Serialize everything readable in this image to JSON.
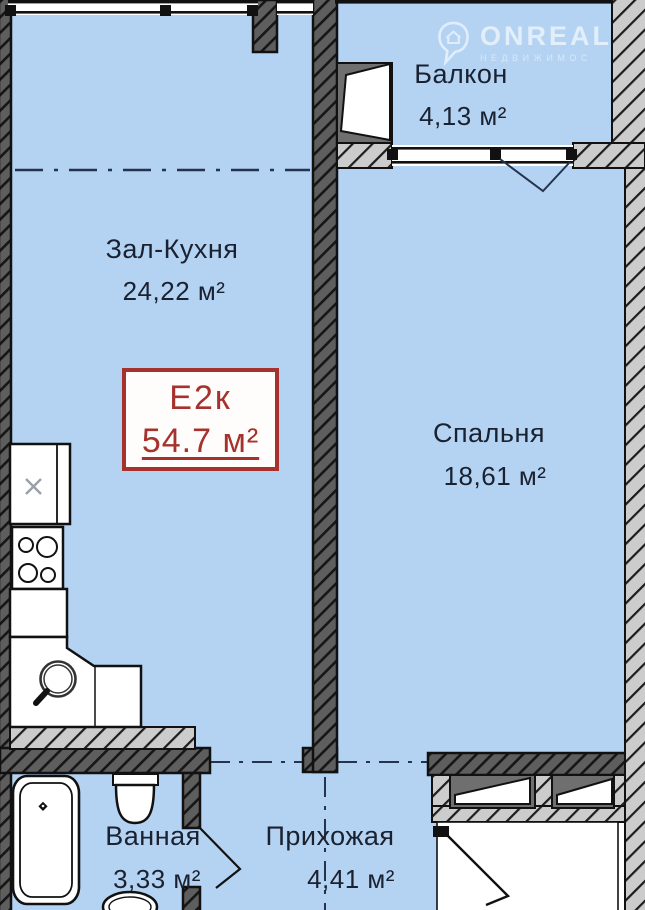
{
  "brand": {
    "name": "ONREAL",
    "subtitle": "НЕДВИЖИМОС"
  },
  "badge": {
    "type": "Е2к",
    "area": "54.7 м²"
  },
  "rooms": {
    "living_kitchen": {
      "name": "Зал-Кухня",
      "area": "24,22 м²"
    },
    "balcony": {
      "name": "Балкон",
      "area": "4,13 м²"
    },
    "bedroom": {
      "name": "Спальня",
      "area": "18,61 м²"
    },
    "bathroom": {
      "name": "Ванная",
      "area": "3,33 м²"
    },
    "hallway": {
      "name": "Прихожая",
      "area": "4,41 м²"
    }
  },
  "colors": {
    "room_fill": "#b4d3f2",
    "wall_dark": "#5e5e5e",
    "wall_light": "#cccccc",
    "line_navy": "#26334e",
    "badge_red": "#a5322c"
  }
}
